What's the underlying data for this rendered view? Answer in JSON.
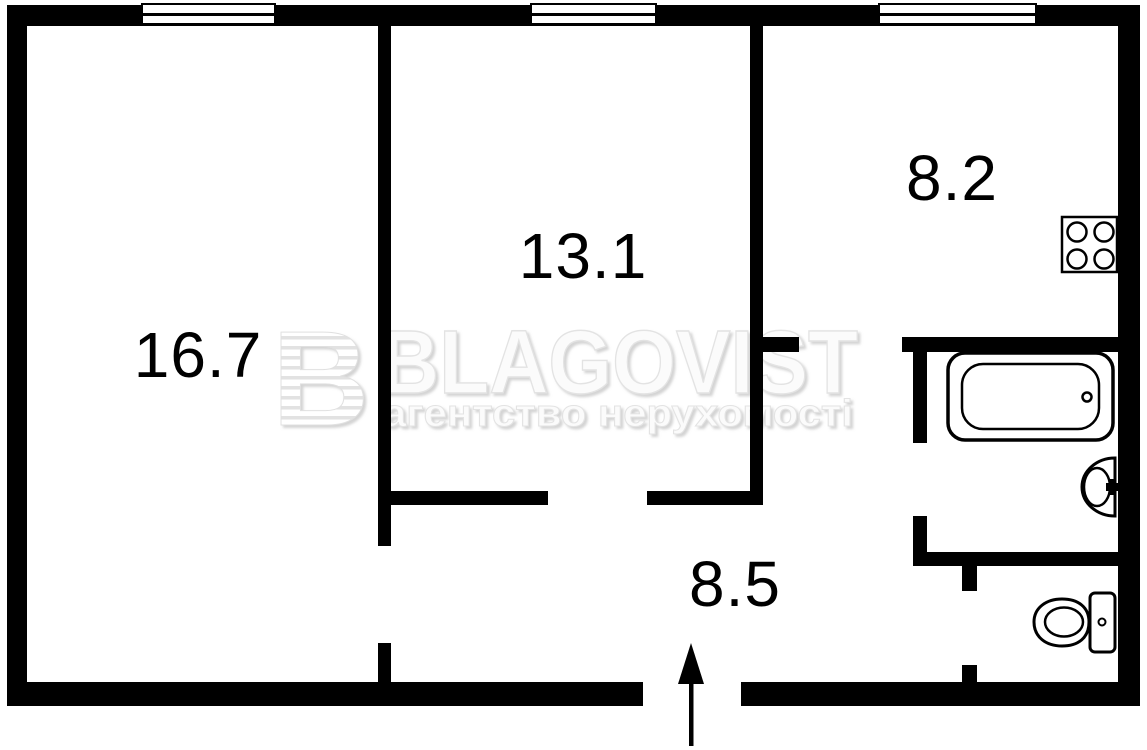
{
  "title": "Apartment floor plan",
  "colors": {
    "wall": "#000000",
    "background": "#ffffff",
    "watermark_gray": "#e9e9e9"
  },
  "rooms": [
    {
      "id": "room-1",
      "area": "16.7"
    },
    {
      "id": "room-2",
      "area": "13.1"
    },
    {
      "id": "kitchen",
      "area": "8.2"
    },
    {
      "id": "hallway",
      "area": "8.5"
    }
  ],
  "watermark": {
    "logo_letter": "B",
    "title": "BLAGOVIST",
    "subtitle": "агентство нерухомості"
  },
  "fixtures": [
    "bathtub",
    "sink",
    "toilet",
    "stove",
    "entry-arrow",
    "window",
    "window",
    "window"
  ]
}
